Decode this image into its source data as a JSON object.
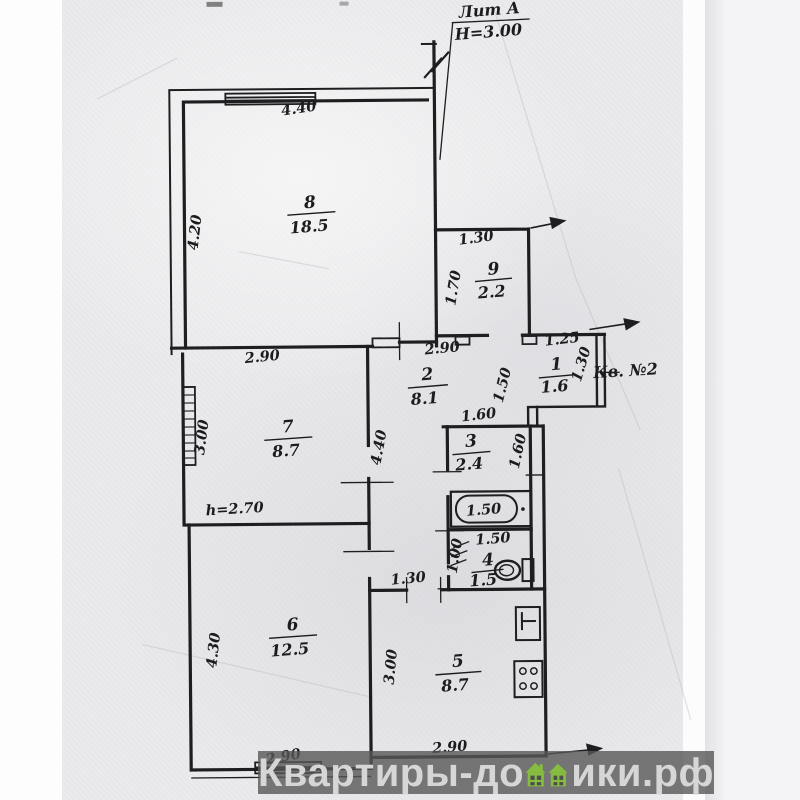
{
  "scan": {
    "labels": {
      "building": "Лит А",
      "height": "Н=3.00",
      "apartment": "Кв. №2",
      "ceiling_height": "h=2.70"
    },
    "rooms": [
      {
        "number": "8",
        "area": "18.5"
      },
      {
        "number": "9",
        "area": "2.2"
      },
      {
        "number": "2",
        "area": "8.1"
      },
      {
        "number": "1",
        "area": "1.6"
      },
      {
        "number": "7",
        "area": "8.7"
      },
      {
        "number": "3",
        "area": "2.4"
      },
      {
        "number": "4",
        "area": "1.5"
      },
      {
        "number": "6",
        "area": "12.5"
      },
      {
        "number": "5",
        "area": "8.7"
      }
    ],
    "dimensions": {
      "room8_width": "4.40",
      "room8_depth": "4.20",
      "room9_width": "1.30",
      "room9_depth": "1.70",
      "hall_width": "2.90",
      "hall_depth": "4.40",
      "hall_opening": "1.50",
      "room1_width": "1.25",
      "room1_depth": "1.30",
      "room7_width": "2.90",
      "room7_depth": "3.00",
      "bath_width": "1.60",
      "bath_depth": "1.60",
      "tub_length": "1.50",
      "wc_width": "1.50",
      "wc_depth": "1.00",
      "kitchen_door": "1.30",
      "room6_depth": "4.30",
      "room6_width": "2.90",
      "kitchen_depth": "3.00",
      "kitchen_width": "2.90"
    }
  },
  "watermark": {
    "text_before": "Квартиры-до",
    "text_after": "ики.рф",
    "house_color": "#86bd3e",
    "window_color": "#4e4e4e",
    "band_color": "#585858",
    "text_color": "#d6d6d6"
  },
  "colors": {
    "paper": "#ebebed",
    "ink": "#1e1e20"
  }
}
